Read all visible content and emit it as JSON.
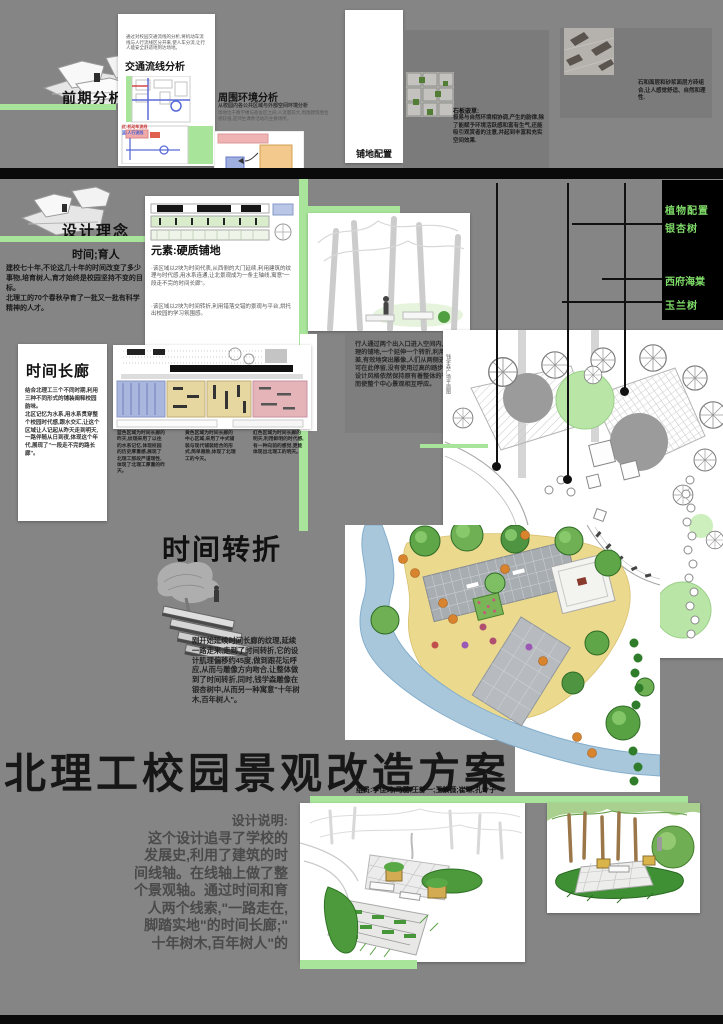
{
  "colors": {
    "accent_green": "#a8e59b",
    "label_green": "#7fdb69",
    "background_gray": "#858585"
  },
  "top": {
    "qianqi_title": "前期分析",
    "jiaotong": {
      "intro": "通过对校园交通流线的分析,将机动车流线与人行流线区分开来,使人车分流,让行人能安全舒适地到达场地。",
      "title": "交通流线分析",
      "legend_red": "红:机动车流线",
      "legend_blue": "蓝:人行流线"
    },
    "zhouwei": {
      "title": "周围环境分析",
      "subtitle": "从校园内各公共区域与外部空间环境分析",
      "body": "场地位于教学楼与宿舍区之间,人流量较大,周围建筑围合感较强,是师生课余活动的主要场所。"
    },
    "pudi": {
      "label": "铺地配置",
      "left_title": "石板嵌草:",
      "left_body": "极易与自然环境相协调,产生的韵律,除了能赋予环境活跃感和富有生气,还能吸引观赏者的注意,并起到丰富和充实空间效果.",
      "right_body": "石和面层和砂浆面层方砖组合,让人感觉舒适、自然和理性."
    }
  },
  "concept": {
    "title": "设计理念",
    "subtitle": "时间;育人",
    "body": "建校七十年,不论这几十年的时间改变了多少事物,培育树人,育才始终是校园坚持不变的目标。\n北理工的70个春秋孕育了一批又一批有科学精神的人才。"
  },
  "yuansu": {
    "title": "元素:硬质铺地",
    "bullet1": "·该区域以2块为时间代表,从西侧的大门延续,利用建筑的纹理与时代感,用水系连通,让北景观成为一条主轴线,寓意\"一段走不完的时间长廊\"。",
    "bullet2": "·该区域以2块为时间转折,利用错落交错的景观与平台,烘托出校园的学习氛围感。"
  },
  "changlang": {
    "title": "时间长廊",
    "body": "结合北理工三个不同时期,利用三种不同形式的铺装阐释校园韵味。\n北区记忆为水系,用水系贯穿整个校园时代感,跟水交汇,让这个区域让人记起从昨天走到明天,一路伴随从日到夜,体现这个年代,展现了\"一段走不完的路长廊\"。"
  },
  "zones": {
    "col1": "蓝色区域为时间长廊的昨天,纹理采用了以往的水系记忆,体现校园的历史厚重感,展现了北理工那段严谨理性,体现了北理工厚重的昨天。",
    "col2": "黄色区域为时间长廊的中心区域,采用了中式铺装与现代铺装结合的形式,简单雅致,体现了北理工的今天。",
    "col3": "红色区域为时间长廊的明天,利用鲜明的时代感,有一种向前的感觉,更能体现出北理工的明天。"
  },
  "xingren": {
    "body": "行人通过两个出入口进入空间内,两边肌理的铺地,一个延伸一个转折,利用高低差,有效地突出雕像,人们从两侧进入都可在此停留,没有使用过高的踏步,整个设计风格依然保持原有着整体的平和,从而使整个中心景观相互呼应。"
  },
  "plants": {
    "title": "植物配置",
    "items": [
      "银杏树",
      "西府海棠",
      "玉兰树"
    ]
  },
  "plan_note": "钱学森广场平面图",
  "zhuanzhe": {
    "title": "时间转折",
    "body": "刚开始延续时间长廊的纹理,延续一路走来,走到了时间转折,它的设计肌理偏移约45度,做到跟花坛呼应,从而与雕像方向吻合,让整体做到了时间转折,同时,钱学森雕像在银杏树中,从而另一种寓意\"十年树木,百年树人\"。"
  },
  "footer": {
    "title": "北理工校园景观改造方案",
    "credits": "组员:李佳玮;马蕊;王舒一;王紫薇;崔琳;孔令子"
  },
  "shuoming": {
    "heading": "设计说明:",
    "lines": [
      "这个设计追寻了学校的",
      "发展史,利用了建筑的时",
      "间线轴。在线轴上做了整",
      "个景观轴。通过时间和育",
      "人两个线索,\"一路走在,",
      "脚踏实地\"的时间长廊;\"",
      "十年树木,百年树人\"的"
    ]
  }
}
